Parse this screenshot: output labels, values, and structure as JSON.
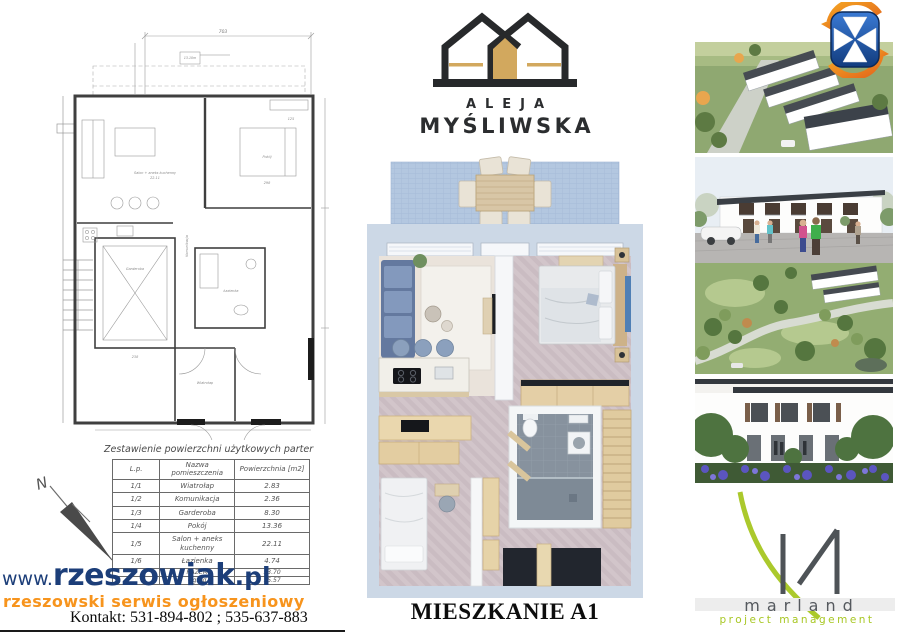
{
  "brand": {
    "line1": "ALEJA",
    "line2": "MYŚLIWSKA",
    "colors": {
      "dark": "#27292b",
      "gold": "#d2a85e"
    }
  },
  "apartment": {
    "title": "MIESZKANIE A1"
  },
  "area_table": {
    "title": "Zestawienie powierzchni użytkowych parter",
    "headers": [
      "L.p.",
      "Nazwa pomieszczenia",
      "Powierzchnia [m2]"
    ],
    "rows": [
      {
        "lp": "1/1",
        "name": "Wiatrołap",
        "area": "2.83"
      },
      {
        "lp": "1/2",
        "name": "Komunikacja",
        "area": "2.36"
      },
      {
        "lp": "1/3",
        "name": "Garderoba",
        "area": "8.30"
      },
      {
        "lp": "1/4",
        "name": "Pokój",
        "area": "13.36"
      },
      {
        "lp": "1/5",
        "name": "Salon + aneks kuchenny",
        "area": "22.11"
      },
      {
        "lp": "1/6",
        "name": "Łazienka",
        "area": "4.74"
      },
      {
        "lp": "",
        "name": "RAZEM",
        "area": "53.70"
      },
      {
        "lp": "",
        "name": "Ogród",
        "area": "15.57"
      }
    ]
  },
  "plan": {
    "dims": {
      "top": "703",
      "bedroom": "298",
      "garderoba": "238",
      "right": "125"
    },
    "north_label": "N"
  },
  "portal": {
    "www": "www.",
    "name": "rzeszowiak",
    "tld": ".pl",
    "tagline": "rzeszowski serwis ogłoszeniowy",
    "contact": "Kontakt: 531-894-802 ; 535-637-883",
    "colors": {
      "navy": "#1c3e79",
      "orange": "#f7941d"
    }
  },
  "developer": {
    "name": "marland",
    "subtitle": "project management",
    "colors": {
      "green": "#a8c724",
      "gray": "#55595e"
    }
  },
  "emblem": {
    "colors": {
      "blue": "#1a4f9e",
      "orange": "#ee8822",
      "cross": "#ffffff"
    }
  }
}
